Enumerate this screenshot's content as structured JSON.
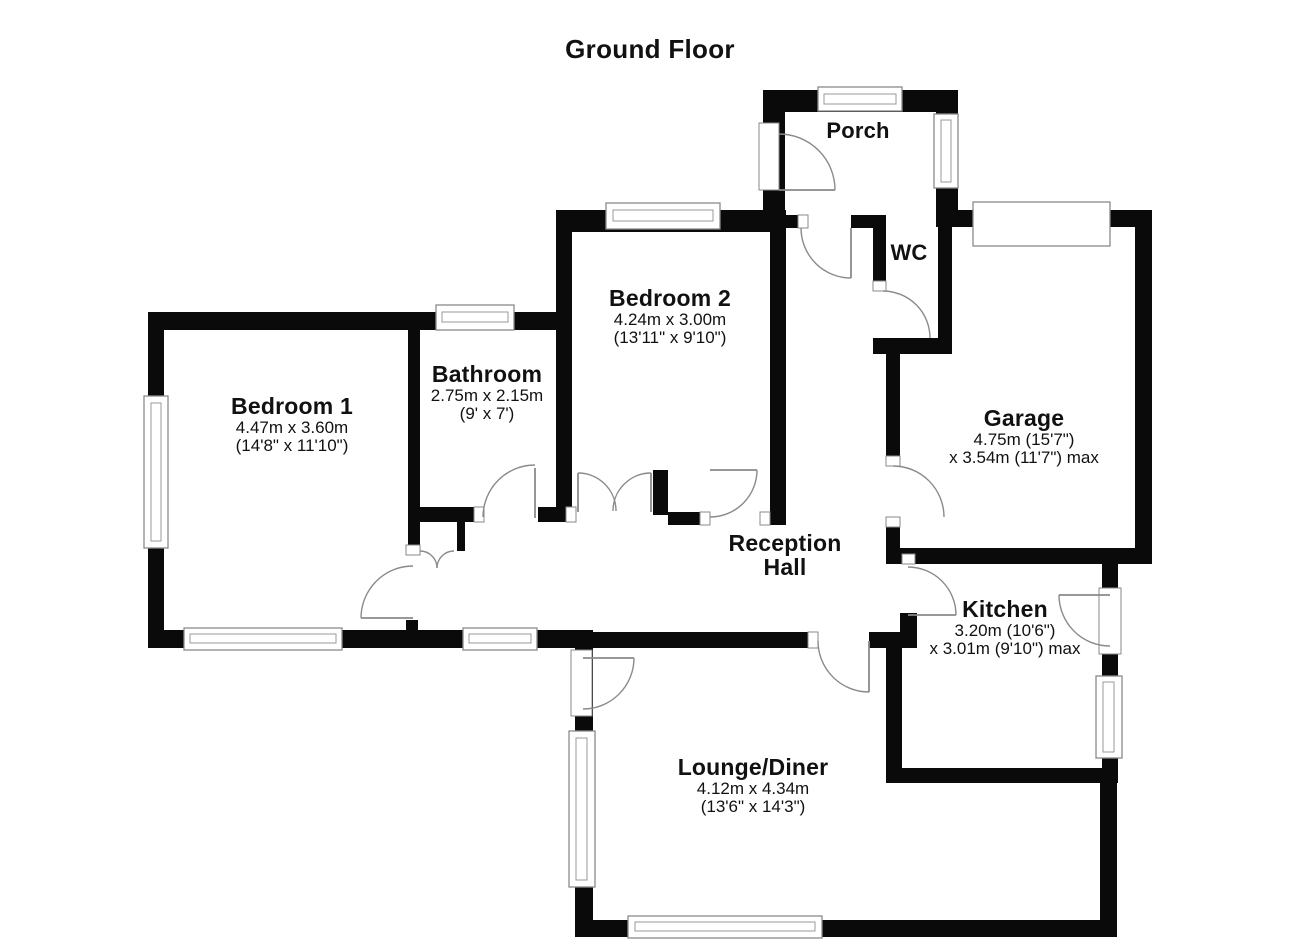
{
  "title": "Ground Floor",
  "rooms": {
    "porch": {
      "name": "Porch"
    },
    "wc": {
      "name": "WC"
    },
    "bedroom2": {
      "name": "Bedroom 2",
      "metric": "4.24m x 3.00m",
      "imperial": "(13'11\" x 9'10\")"
    },
    "bathroom": {
      "name": "Bathroom",
      "metric": "2.75m x 2.15m",
      "imperial": "(9' x 7')"
    },
    "bedroom1": {
      "name": "Bedroom 1",
      "metric": "4.47m x 3.60m",
      "imperial": "(14'8\" x 11'10\")"
    },
    "garage": {
      "name": "Garage",
      "metric": "4.75m (15'7\")",
      "imperial": "x 3.54m (11'7\") max"
    },
    "reception_hall": {
      "name_line1": "Reception",
      "name_line2": "Hall"
    },
    "kitchen": {
      "name": "Kitchen",
      "metric": "3.20m (10'6\")",
      "imperial": "x 3.01m (9'10\") max"
    },
    "lounge_diner": {
      "name": "Lounge/Diner",
      "metric": "4.12m x 4.34m",
      "imperial": "(13'6\" x 14'3\")"
    }
  },
  "colors": {
    "wall": "#0a0a0a",
    "fixture_line": "#8a8a8a",
    "text": "#111111",
    "background": "#ffffff"
  }
}
